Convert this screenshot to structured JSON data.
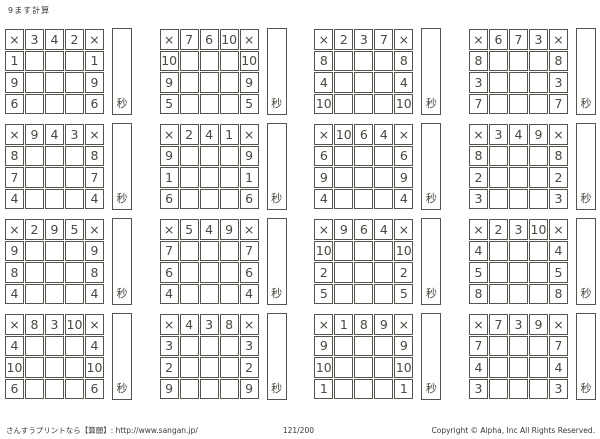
{
  "page": {
    "title": "9ます計算"
  },
  "symbols": {
    "multiply": "×",
    "seconds": "秒"
  },
  "grids": [
    {
      "top": [
        "3",
        "4",
        "2"
      ],
      "left": [
        "1",
        "9",
        "6"
      ]
    },
    {
      "top": [
        "7",
        "6",
        "10"
      ],
      "left": [
        "10",
        "9",
        "5"
      ]
    },
    {
      "top": [
        "2",
        "3",
        "7"
      ],
      "left": [
        "8",
        "4",
        "10"
      ]
    },
    {
      "top": [
        "6",
        "7",
        "3"
      ],
      "left": [
        "8",
        "3",
        "7"
      ]
    },
    {
      "top": [
        "9",
        "4",
        "3"
      ],
      "left": [
        "8",
        "7",
        "4"
      ]
    },
    {
      "top": [
        "2",
        "4",
        "1"
      ],
      "left": [
        "9",
        "1",
        "6"
      ]
    },
    {
      "top": [
        "10",
        "6",
        "4"
      ],
      "left": [
        "6",
        "9",
        "4"
      ]
    },
    {
      "top": [
        "3",
        "4",
        "9"
      ],
      "left": [
        "8",
        "2",
        "3"
      ]
    },
    {
      "top": [
        "2",
        "9",
        "5"
      ],
      "left": [
        "9",
        "8",
        "4"
      ]
    },
    {
      "top": [
        "5",
        "4",
        "9"
      ],
      "left": [
        "7",
        "6",
        "4"
      ]
    },
    {
      "top": [
        "9",
        "6",
        "4"
      ],
      "left": [
        "10",
        "2",
        "5"
      ]
    },
    {
      "top": [
        "2",
        "3",
        "10"
      ],
      "left": [
        "4",
        "5",
        "8"
      ]
    },
    {
      "top": [
        "8",
        "3",
        "10"
      ],
      "left": [
        "4",
        "10",
        "6"
      ]
    },
    {
      "top": [
        "4",
        "3",
        "8"
      ],
      "left": [
        "3",
        "2",
        "9"
      ]
    },
    {
      "top": [
        "1",
        "8",
        "9"
      ],
      "left": [
        "9",
        "10",
        "1"
      ]
    },
    {
      "top": [
        "7",
        "3",
        "9"
      ],
      "left": [
        "7",
        "4",
        "3"
      ]
    }
  ],
  "footer": {
    "left": "さんすうプリントなら【算願】: http://www.sangan.jp/",
    "center": "121/200",
    "right": "Copyright © Alpha, Inc All Rights Reserved."
  }
}
